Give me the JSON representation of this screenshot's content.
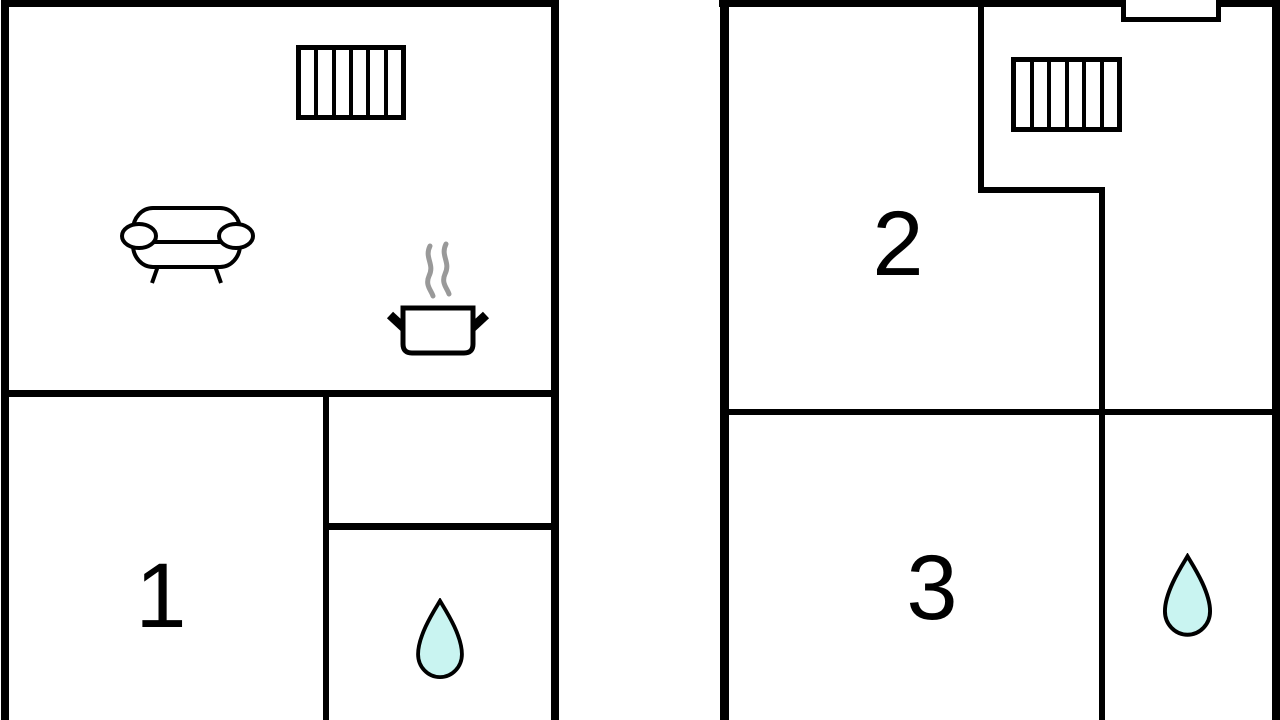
{
  "colors": {
    "wall": "#000000",
    "background": "#ffffff",
    "water_drop_fill": "#c9f4f1",
    "steam": "#999999"
  },
  "rooms": {
    "room1": "1",
    "room2": "2",
    "room3": "3"
  },
  "icons": {
    "window": "window-icon",
    "sofa": "sofa-icon",
    "cooking_pot": "cooking-pot-icon",
    "water_drop": "water-drop-icon"
  }
}
